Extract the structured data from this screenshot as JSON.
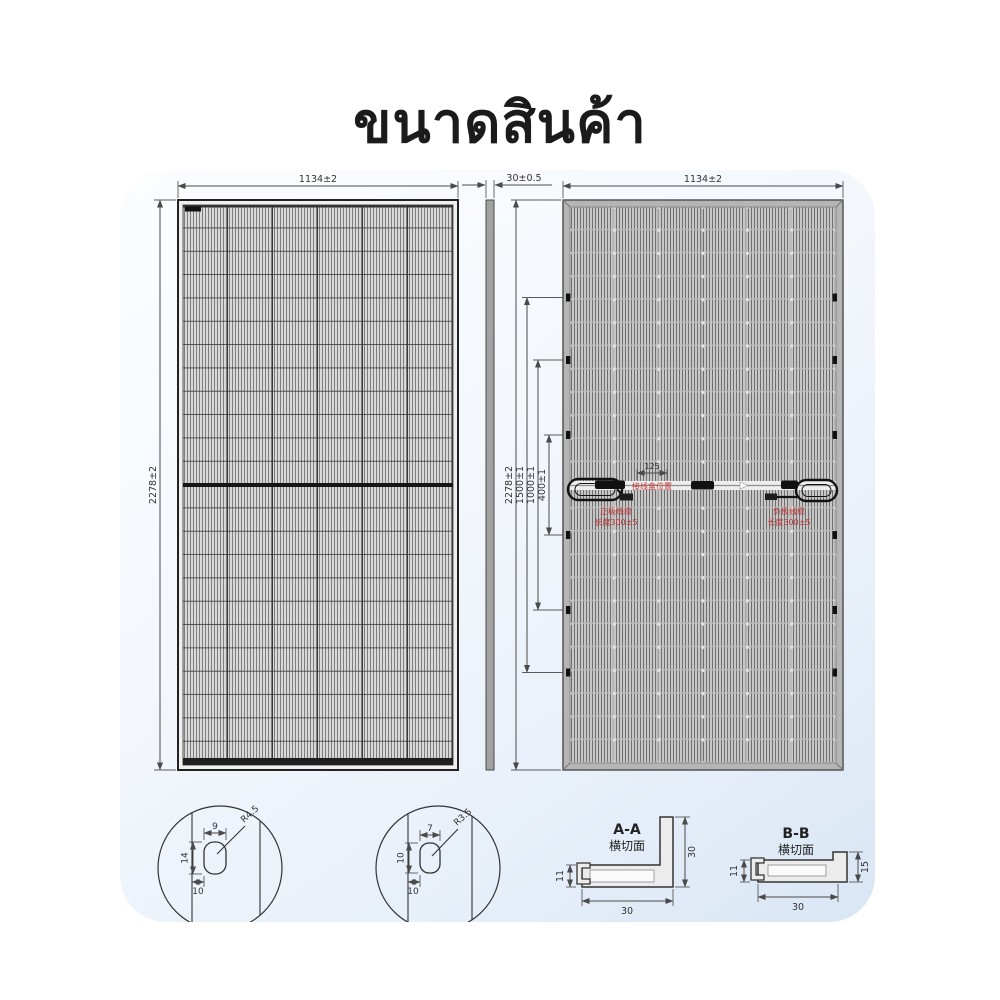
{
  "title": "ขนาดสินค้า",
  "front_view": {
    "width_dim": "1134±2",
    "height_dim": "2278±2"
  },
  "side_view": {
    "thickness_dim": "30±0.5"
  },
  "back_view": {
    "width_dim": "1134±2",
    "height_dim": "2278±2",
    "mount_dim_1500": "1500±1",
    "mount_dim_1000": "1000±1",
    "mount_dim_400": "400±1",
    "jbox_width_dim": "125",
    "jbox_note": "接线盒位置",
    "cable_left_line1": "正极线缆",
    "cable_left_line2": "长度300±5",
    "cable_right_line1": "负极线缆",
    "cable_right_line2": "长度300±5"
  },
  "detail_a": {
    "slot_width": "9",
    "slot_height": "14",
    "edge_offset": "10",
    "corner_radius": "R4.5"
  },
  "detail_b": {
    "slot_width": "7",
    "slot_height": "10",
    "edge_offset": "10",
    "corner_radius": "R3.5"
  },
  "section_aa": {
    "label": "A-A",
    "sublabel": "横切面",
    "lip_height": "11",
    "wall_height": "30",
    "base_width": "30"
  },
  "section_bb": {
    "label": "B-B",
    "sublabel": "横切面",
    "lip_height": "11",
    "wall_height": "15",
    "base_width": "30"
  },
  "colors": {
    "accent_red": "#c23333",
    "frame_gray": "#b5b5b5",
    "line_dark": "#333333"
  }
}
